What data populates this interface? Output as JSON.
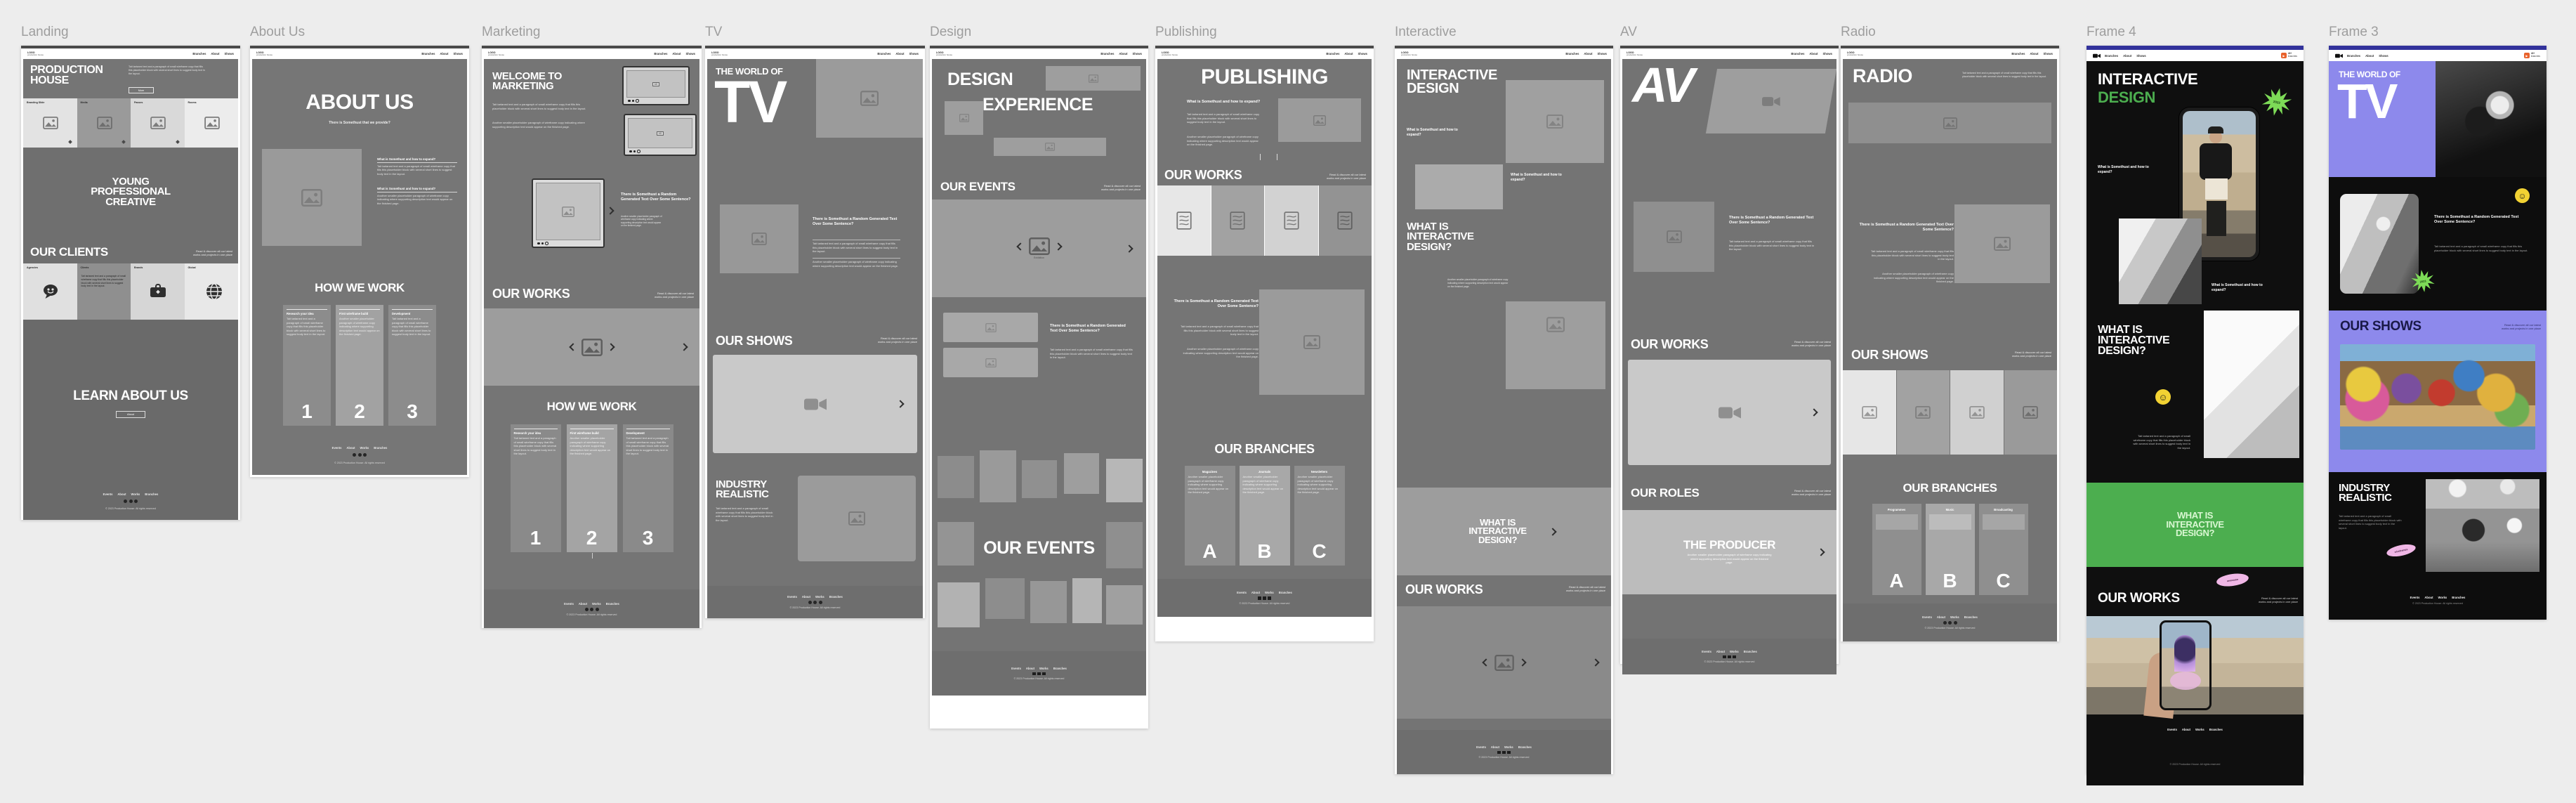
{
  "canvas": {
    "bg": "#ededed"
  },
  "colors": {
    "navy": "#32329b",
    "green": "#4cae4f",
    "bright_green": "#7ddb57",
    "yellow": "#f2d233",
    "pink": "#f0b7e6",
    "purple": "#8d89ec",
    "orange": "#e8622c",
    "body_gray": "#757575"
  },
  "common": {
    "logo_line1": "LOGO",
    "logo_line2": "production house",
    "nav": [
      "Branches",
      "About",
      "Shows"
    ],
    "footer_links": [
      "Events",
      "About",
      "Works",
      "Branches"
    ],
    "copyright": "© 2023 Production House. All rights reserved",
    "aside1": "Read & discover all our latest",
    "aside2": "works and projects in one place",
    "more": "More"
  },
  "lorem": {
    "q": "There is Somethust a Random Generated Text Over Some Sentence?",
    "q2": "What is Somethust and how to expand?",
    "p1": "Tait tartaned text and a paragraph of small wireframe copy that fills this placeholder block with several short lines to suggest body text in the layout.",
    "p2": "Another smaller placeholder paragraph of wireframe copy indicating where supporting description text would appear on the finished page."
  },
  "frames": {
    "landing": {
      "label": "Landing",
      "hero_title": "PRODUCTION HOUSE",
      "band": "YOUNG PROFESSIONAL CREATIVE",
      "clients_heading": "OUR CLIENTS",
      "cta": "LEARN ABOUT US",
      "cta_btn": "About",
      "cards": [
        "Branding Slide",
        "Media",
        "Passes",
        "Rooms"
      ],
      "client_cards": [
        "Agencies",
        "Clients",
        "Brands",
        "Global"
      ]
    },
    "about": {
      "label": "About Us",
      "title": "ABOUT US",
      "subtitle": "There is Somethust that we provide?",
      "how": "HOW WE WORK",
      "steps": [
        {
          "n": "1",
          "t": "Research your idea"
        },
        {
          "n": "2",
          "t": "First wireframe build"
        },
        {
          "n": "3",
          "t": "Development"
        }
      ]
    },
    "marketing": {
      "label": "Marketing",
      "title": "WELCOME TO MARKETING",
      "works": "OUR WORKS",
      "how": "HOW WE WORK",
      "steps": [
        {
          "n": "1",
          "t": "Research your idea"
        },
        {
          "n": "2",
          "t": "First wireframe build"
        },
        {
          "n": "3",
          "t": "Development"
        }
      ]
    },
    "tv": {
      "label": "TV",
      "hero_small": "THE WORLD OF",
      "hero_big": "TV",
      "shows": "OUR SHOWS",
      "industry": "INDUSTRY REALISTIC"
    },
    "design": {
      "label": "Design",
      "hero1": "DESIGN",
      "hero2": "EXPERIENCE",
      "events": "OUR EVENTS",
      "events_big": "OUR EVENTS",
      "carousel_caption": "Exhibition"
    },
    "publishing": {
      "label": "Publishing",
      "title": "PUBLISHING",
      "works": "OUR WORKS",
      "branches": "OUR BRANCHES",
      "branch_cards": [
        {
          "letter": "A",
          "t": "Magazines"
        },
        {
          "letter": "B",
          "t": "Journals"
        },
        {
          "letter": "C",
          "t": "Newsletters"
        }
      ]
    },
    "interactive": {
      "label": "Interactive",
      "title": "INTERACTIVE DESIGN",
      "what": "WHAT IS INTERACTIVE DESIGN?",
      "band": "WHAT IS INTERACTIVE DESIGN?",
      "works": "OUR WORKS"
    },
    "av": {
      "label": "AV",
      "title": "AV",
      "works": "OUR WORKS",
      "roles": "OUR ROLES",
      "producer": "THE PRODUCER"
    },
    "radio": {
      "label": "Radio",
      "title": "RADIO",
      "shows": "OUR SHOWS",
      "branches": "OUR BRANCHES",
      "branch_cards": [
        {
          "letter": "A",
          "t": "Programmes"
        },
        {
          "letter": "B",
          "t": "Music"
        },
        {
          "letter": "C",
          "t": "Broadcasting"
        }
      ]
    },
    "frame4": {
      "label": "Frame 4",
      "hero1": "INTERACTIVE",
      "hero2": "DESIGN",
      "what": "WHAT IS INTERACTIVE DESIGN?",
      "band": "WHAT IS INTERACTIVE DESIGN?",
      "works": "OUR WORKS",
      "badge1": "40+",
      "badge2": "branches",
      "sticker_star": "2023",
      "sticker_pink": "awesome",
      "smiley": "☺"
    },
    "frame3": {
      "label": "Frame 3",
      "hero_small": "THE WORLD OF",
      "hero_big": "TV",
      "shows": "OUR SHOWS",
      "industry": "INDUSTRY REALISTIC",
      "badge1": "40+",
      "badge2": "branches",
      "sticker_pink": "wireframes",
      "smiley": "☺"
    }
  }
}
